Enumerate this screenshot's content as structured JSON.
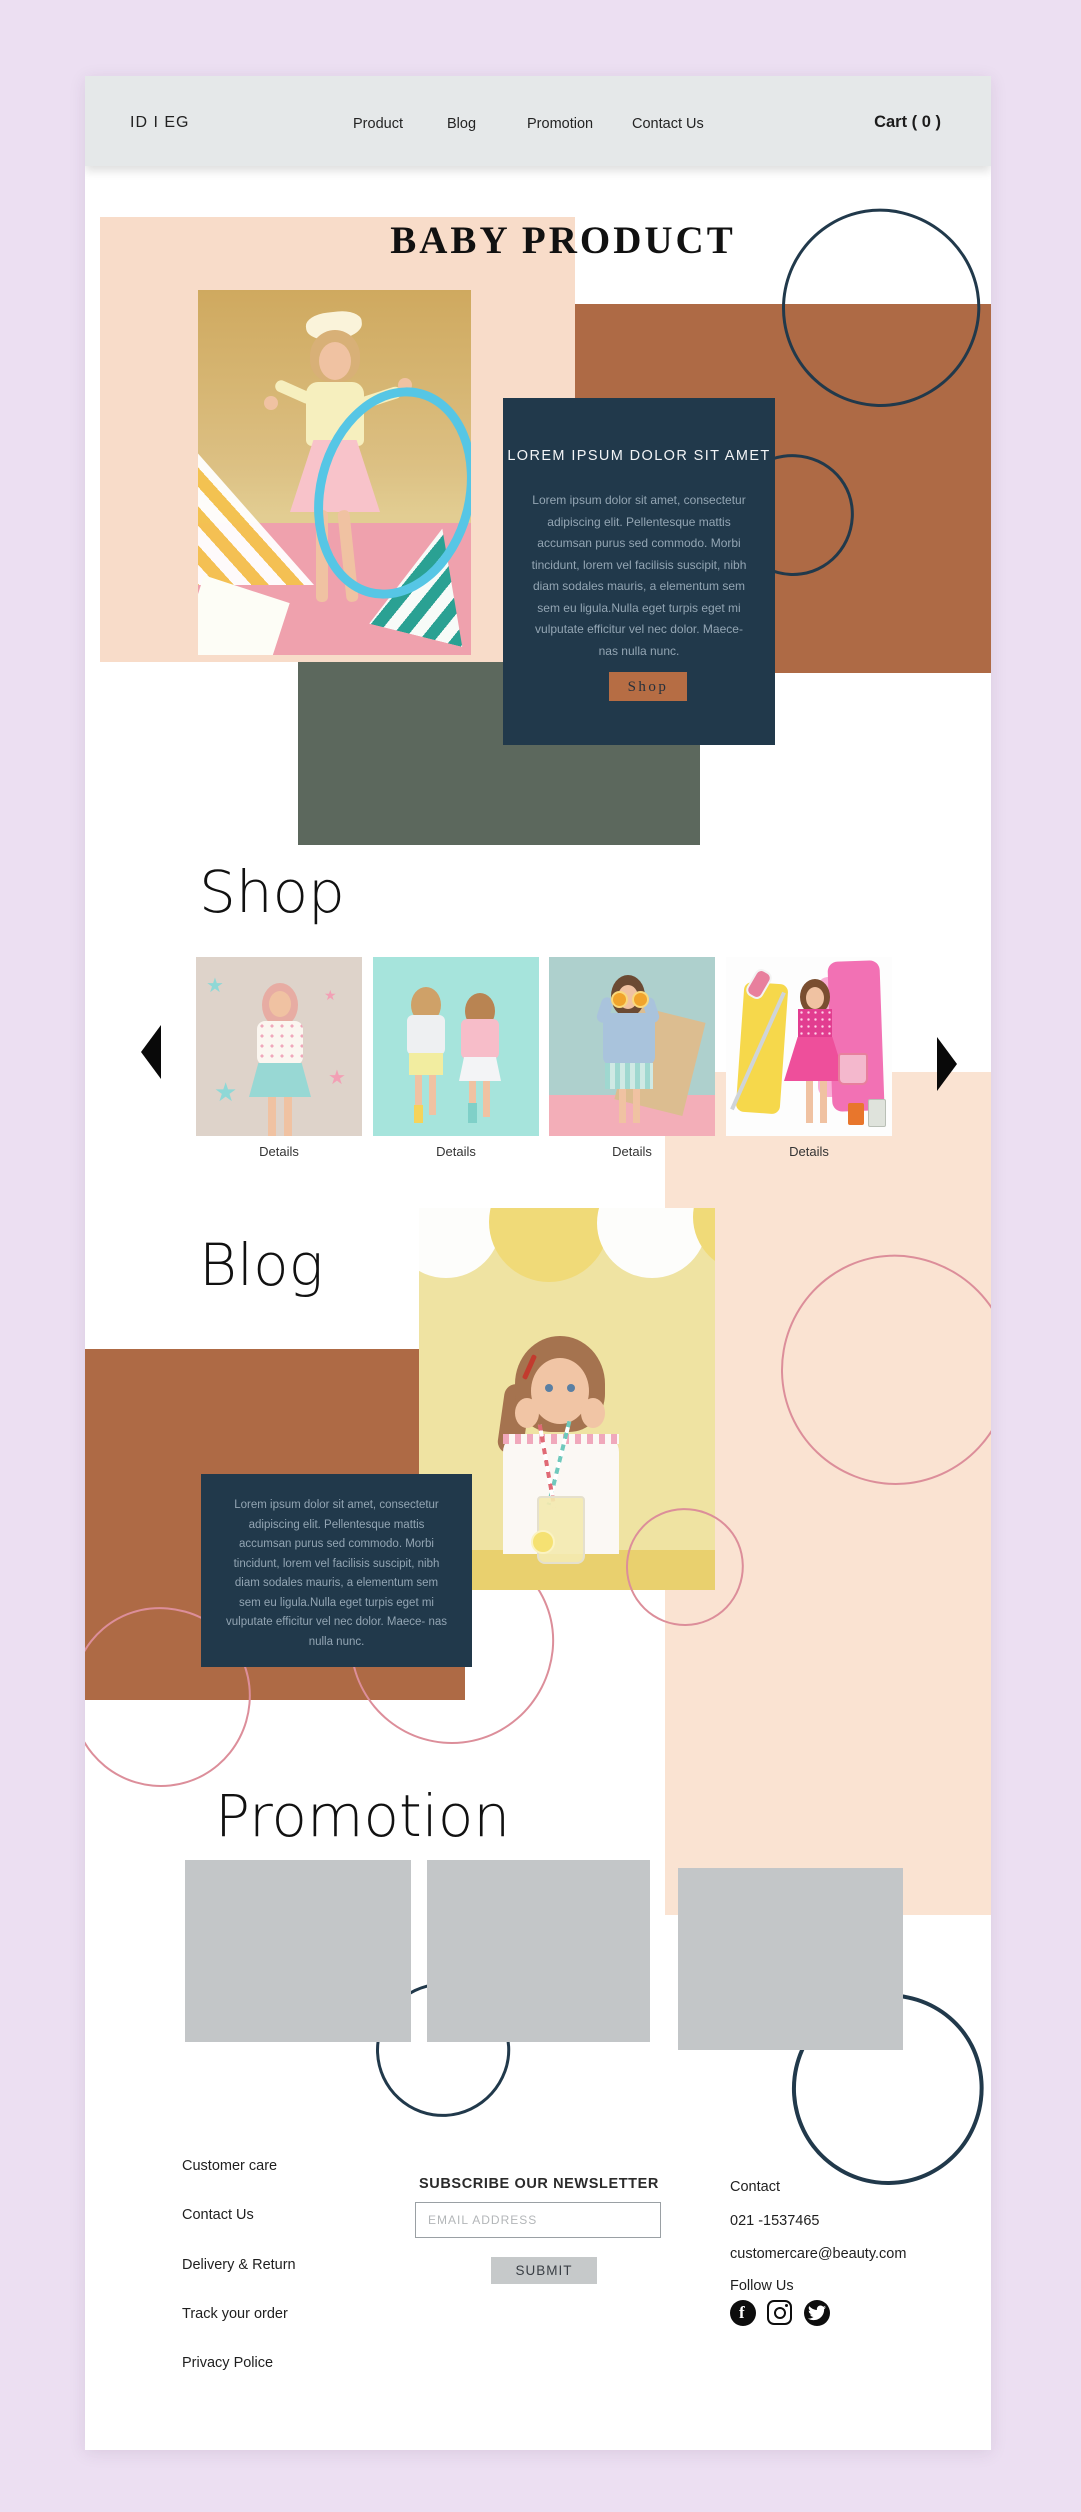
{
  "header": {
    "logo": "ID I EG",
    "nav": [
      "Product",
      "Blog",
      "Promotion",
      "Contact Us"
    ],
    "cart_label": "Cart ( 0 )"
  },
  "hero": {
    "title": "BABY PRODUCT",
    "card": {
      "heading": "LOREM IPSUM DOLOR SIT AMET",
      "body": "Lorem ipsum dolor sit amet, consectetur adipiscing elit. Pellentesque mattis accumsan purus sed commodo. Morbi tincidunt, lorem vel facilisis suscipit, nibh diam sodales mauris, a elementum sem sem eu ligula.Nulla eget turpis eget mi vulputate efficitur vel nec dolor. Maece- nas nulla nunc.",
      "button_label": "Shop"
    }
  },
  "shop": {
    "heading": "Shop",
    "items": [
      {
        "details_label": "Details"
      },
      {
        "details_label": "Details"
      },
      {
        "details_label": "Details"
      },
      {
        "details_label": "Details"
      }
    ]
  },
  "blog": {
    "heading": "Blog",
    "card_body": "Lorem ipsum dolor sit amet, consectetur adipiscing elit. Pellentesque mattis accumsan purus sed commodo. Morbi tincidunt, lorem vel facilisis suscipit, nibh diam sodales mauris, a elementum sem sem eu ligula.Nulla eget turpis eget mi vulputate efficitur vel nec dolor. Maece- nas nulla nunc."
  },
  "promotion": {
    "heading": "Promotion"
  },
  "footer": {
    "links": [
      "Customer care",
      "Contact Us",
      "Delivery & Return",
      "Track your order",
      "Privacy Police"
    ],
    "newsletter": {
      "title": "SUBSCRIBE OUR NEWSLETTER",
      "placeholder": "EMAIL ADDRESS",
      "submit_label": "SUBMIT"
    },
    "contact": {
      "heading": "Contact",
      "phone": "021 -1537465",
      "email": "customercare@beauty.com",
      "follow": "Follow Us"
    }
  },
  "icons": {
    "carousel_left": "chevron-left-icon",
    "carousel_right": "chevron-right-icon",
    "social": [
      "facebook-icon",
      "instagram-icon",
      "twitter-icon"
    ]
  },
  "colors": {
    "outer_background": "#ecdff2",
    "header_bar": "#e5e8e9",
    "peach_block": "#f8dcc9",
    "brown_block": "#ae6a45",
    "olive_block": "#5c685d",
    "navy_card": "#21394b",
    "navy_card_text": "#93a5b3",
    "shop_button": "#b66d44",
    "pink_circle_stroke": "#dc8e9a",
    "navy_circle_stroke": "#21394b",
    "promo_placeholder": "#c3c6c8",
    "submit_button": "#c6c9ca"
  }
}
